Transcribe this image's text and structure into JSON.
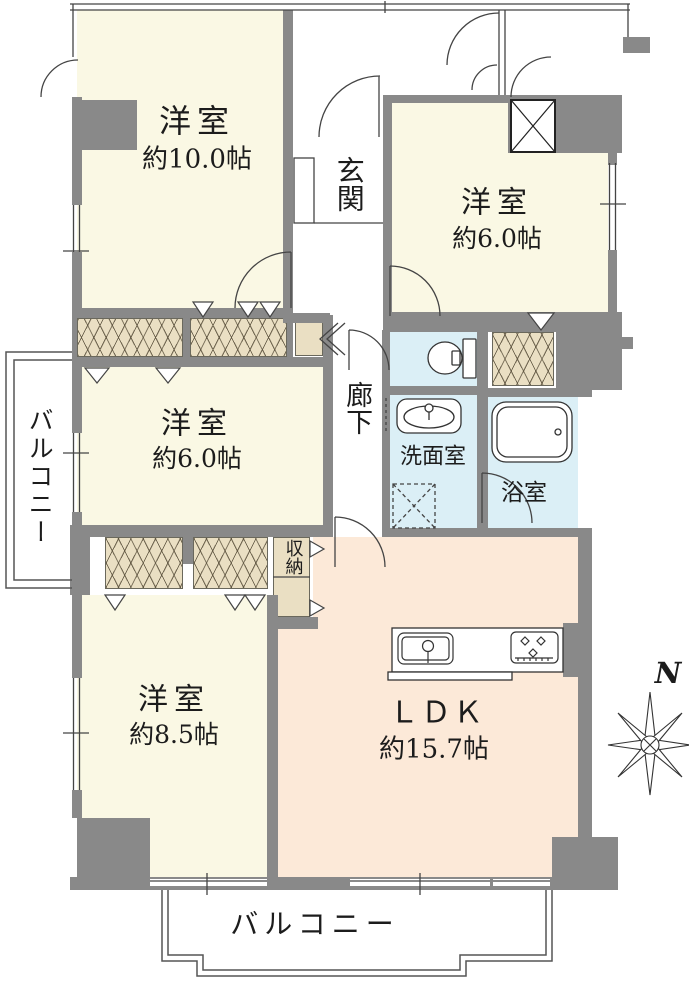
{
  "plan_title": "3LDK apartment floor plan",
  "colors": {
    "wall": "#898989",
    "room": "#FAF8E4",
    "water": "#DBEFF6",
    "ldk": "#FCE9D8",
    "closet": "#EADFC3",
    "line": "#3a3a3a",
    "bline": "#555555"
  },
  "rooms": {
    "bedroom10": {
      "name": "洋室",
      "size": "約10.0帖"
    },
    "bedroom6r": {
      "name": "洋室",
      "size": "約6.0帖"
    },
    "bedroom6l": {
      "name": "洋室",
      "size": "約6.0帖"
    },
    "bedroom85": {
      "name": "洋室",
      "size": "約8.5帖"
    },
    "ldk": {
      "name": "ＬＤＫ",
      "size": "約15.7帖"
    },
    "entrance": {
      "name": "玄関"
    },
    "corridor": {
      "name": "廊下"
    },
    "washroom": {
      "name": "洗面室"
    },
    "bathroom": {
      "name": "浴室"
    },
    "storage": {
      "name": "収納"
    },
    "balconyLeft": {
      "name": "バルコニー"
    },
    "balconyBottom": {
      "name": "バルコニー"
    }
  },
  "compass": {
    "north_label": "N"
  },
  "icons": {
    "toilet": "toilet-icon",
    "bathtub": "bathtub-icon",
    "washbasin": "washbasin-icon",
    "washing_machine": "washing-machine-icon",
    "kitchen_sink": "kitchen-sink-icon",
    "stove": "stove-icon",
    "compass": "compass-rose-icon",
    "pipe_space": "pipe-space-x-icon"
  }
}
